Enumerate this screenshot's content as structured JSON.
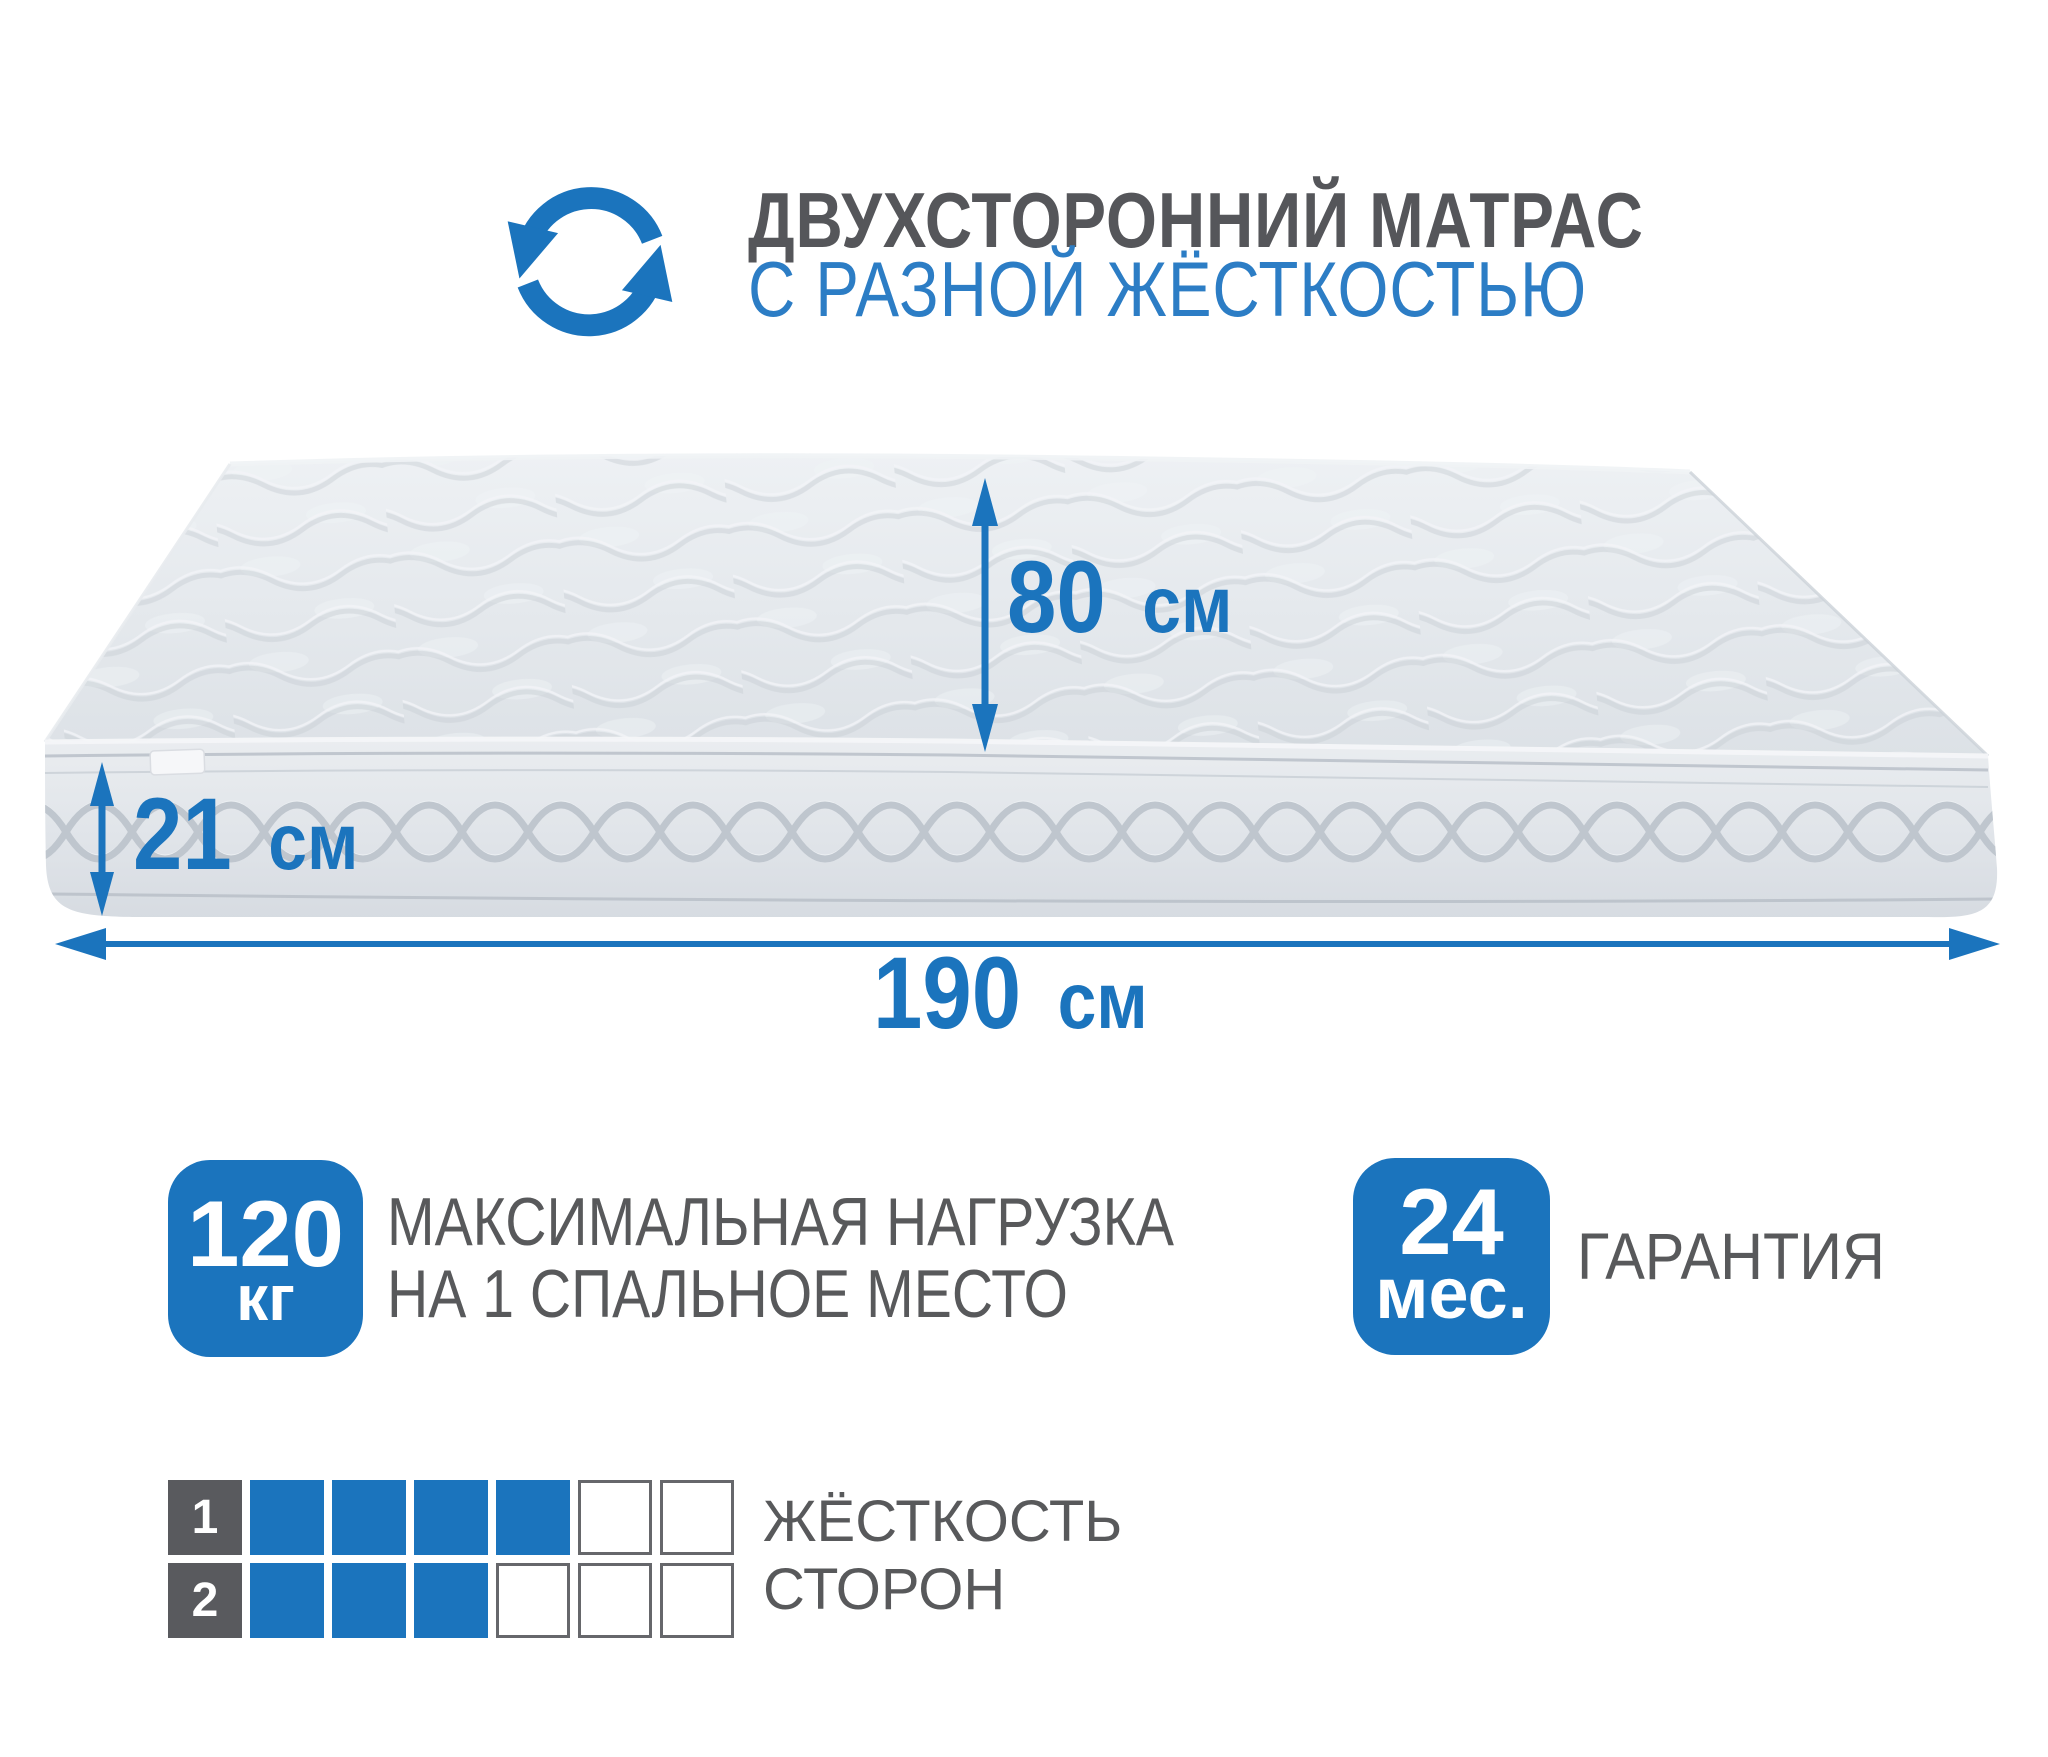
{
  "colors": {
    "accent": "#1b74bd",
    "subtitle_blue": "#2c7dc5",
    "title_gray": "#55565a",
    "text_gray": "#58595b",
    "grid_label_bg": "#595a5e",
    "grid_empty_border": "#66676b",
    "mattress_light": "#edf0f3",
    "mattress_mid": "#dde2e7",
    "mattress_seam": "#b9c0c8"
  },
  "header": {
    "title_line1": "ДВУХСТОРОННИЙ МАТРАС",
    "title_line2": "С РАЗНОЙ ЖЁСТКОСТЬЮ",
    "icon": "rotate-arrows-icon"
  },
  "dimensions": {
    "width": {
      "value": "80",
      "unit": "см"
    },
    "height": {
      "value": "21",
      "unit": "см"
    },
    "length": {
      "value": "190",
      "unit": "см"
    }
  },
  "badges": {
    "max_load": {
      "value": "120",
      "unit": "кг",
      "label_line1": "МАКСИМАЛЬНАЯ НАГРУЗКА",
      "label_line2": "НА 1 СПАЛЬНОЕ МЕСТО"
    },
    "warranty": {
      "value": "24",
      "unit": "мес.",
      "label": "ГАРАНТИЯ"
    }
  },
  "firmness": {
    "label_line1": "ЖЁСТКОСТЬ",
    "label_line2": "СТОРОН",
    "scale_max": 6,
    "sides": [
      {
        "number": "1",
        "filled": 4
      },
      {
        "number": "2",
        "filled": 3
      }
    ]
  }
}
